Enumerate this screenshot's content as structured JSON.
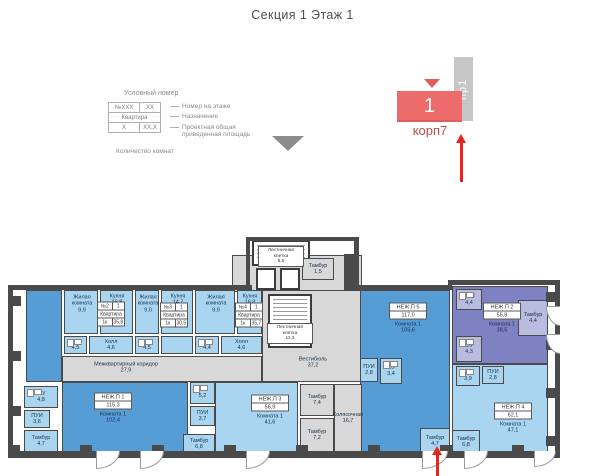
{
  "title": "Секция 1 Этаж 1",
  "legend": {
    "heading": "Условный номер",
    "rows": [
      [
        "№XXX",
        "XX"
      ],
      [
        "Квартира"
      ],
      [
        "X",
        "XX,X"
      ]
    ],
    "labels": [
      "Номер на этаже",
      "Назначение",
      "Проектная общая приведенная площадь"
    ],
    "footer": "Количество комнат"
  },
  "marker": {
    "tab": "пр1",
    "number": "1",
    "building": "корп7"
  },
  "colors": {
    "accent_red": "#e8251a",
    "marker_fill": "#ec6b6b",
    "marker_text": "#bf4e4a",
    "tab_fill": "#c6c6c6",
    "room_light": "#a9d5f0",
    "room_medium": "#569dd6",
    "room_purple": "#7e81c2",
    "room_common": "#d8d8d8",
    "wall": "#4a4a4a"
  },
  "plan": {
    "items": [
      {
        "t": "r",
        "id": "tower-base",
        "x": 232,
        "y": 255,
        "w": 130,
        "h": 37,
        "f": "gy"
      },
      {
        "t": "r",
        "id": "vestibule",
        "x": 262,
        "y": 290,
        "w": 100,
        "h": 92,
        "f": "gy",
        "label": [
          "Вестибюль",
          "37,2"
        ],
        "lx": 50,
        "ly": 72
      },
      {
        "t": "r",
        "id": "corridor",
        "x": 62,
        "y": 356,
        "w": 200,
        "h": 26,
        "f": "gy",
        "label": [
          "Межквартирный коридор",
          "27,9"
        ],
        "lx": 63,
        "ly": 11
      },
      {
        "t": "r",
        "id": "unit1-strip",
        "x": 26,
        "y": 290,
        "w": 36,
        "h": 92,
        "f": "mb"
      },
      {
        "t": "r",
        "id": "unit1-main",
        "x": 62,
        "y": 382,
        "w": 126,
        "h": 72,
        "f": "mb"
      },
      {
        "t": "r",
        "id": "unit5-main",
        "x": 360,
        "y": 290,
        "w": 90,
        "h": 164,
        "f": "mb"
      },
      {
        "t": "r",
        "id": "unit2-main",
        "x": 452,
        "y": 286,
        "w": 96,
        "h": 78,
        "f": "pu"
      },
      {
        "t": "r",
        "id": "unit4-main",
        "x": 452,
        "y": 364,
        "w": 96,
        "h": 90,
        "f": "lb"
      },
      {
        "t": "r",
        "id": "unit3-main",
        "x": 215,
        "y": 382,
        "w": 83,
        "h": 72,
        "f": "lb"
      },
      {
        "t": "r",
        "id": "living-room-1",
        "x": 64,
        "y": 290,
        "w": 34,
        "h": 44,
        "f": "lb",
        "label": [
          "Жилая",
          "комната",
          "9,9"
        ],
        "lx": 17,
        "ly": 13
      },
      {
        "t": "r",
        "id": "kitchen-1",
        "x": 100,
        "y": 290,
        "w": 33,
        "h": 44,
        "f": "lb",
        "label": [
          "Кухня",
          "16,8"
        ],
        "lx": 16,
        "ly": 9
      },
      {
        "t": "r",
        "id": "living-room-2",
        "x": 135,
        "y": 290,
        "w": 24,
        "h": 44,
        "f": "lb",
        "label": [
          "Жилая",
          "комната",
          "9,0"
        ],
        "lx": 12,
        "ly": 13
      },
      {
        "t": "r",
        "id": "kitchen-2",
        "x": 161,
        "y": 290,
        "w": 32,
        "h": 44,
        "f": "lb",
        "label": [
          "Кухня",
          "14,7"
        ],
        "lx": 16,
        "ly": 9
      },
      {
        "t": "r",
        "id": "living-room-3",
        "x": 195,
        "y": 290,
        "w": 40,
        "h": 44,
        "f": "lb",
        "label": [
          "Жилая",
          "комната",
          "9,9"
        ],
        "lx": 20,
        "ly": 13
      },
      {
        "t": "r",
        "id": "kitchen-3",
        "x": 237,
        "y": 290,
        "w": 25,
        "h": 44,
        "f": "lb",
        "label": [
          "Кухня",
          "16,8"
        ],
        "lx": 12,
        "ly": 9
      },
      {
        "t": "r",
        "id": "wc-apt2",
        "x": 64,
        "y": 336,
        "w": 23,
        "h": 18,
        "f": "lb",
        "fx": true,
        "label": [
          "С/У",
          "4,5"
        ]
      },
      {
        "t": "r",
        "id": "hall-apt2",
        "x": 89,
        "y": 336,
        "w": 44,
        "h": 18,
        "f": "lb",
        "label": [
          "Холл",
          "4,6"
        ]
      },
      {
        "t": "r",
        "id": "wc-apt3",
        "x": 135,
        "y": 336,
        "w": 24,
        "h": 18,
        "f": "lb",
        "fx": true,
        "label": [
          "С/У",
          "4,5"
        ]
      },
      {
        "t": "r",
        "id": "hall-apt3",
        "x": 161,
        "y": 336,
        "w": 32,
        "h": 18,
        "f": "lb"
      },
      {
        "t": "r",
        "id": "wc-apt4",
        "x": 195,
        "y": 336,
        "w": 24,
        "h": 18,
        "f": "lb",
        "fx": true,
        "label": [
          "С/У",
          "4,4"
        ]
      },
      {
        "t": "r",
        "id": "hall-apt4",
        "x": 221,
        "y": 336,
        "w": 41,
        "h": 18,
        "f": "lb",
        "label": [
          "Холл",
          "4,6"
        ]
      },
      {
        "t": "r",
        "id": "unit1-wc",
        "x": 24,
        "y": 386,
        "w": 34,
        "h": 22,
        "f": "lb",
        "fx": true,
        "label": [
          "С/У",
          "4,8"
        ]
      },
      {
        "t": "r",
        "id": "unit1-pui",
        "x": 24,
        "y": 410,
        "w": 26,
        "h": 18,
        "f": "lb",
        "label": [
          "ПУИ",
          "3,6"
        ]
      },
      {
        "t": "r",
        "id": "unit1-tambour",
        "x": 24,
        "y": 430,
        "w": 34,
        "h": 22,
        "f": "lb",
        "label": [
          "Тамбур",
          "4,7"
        ]
      },
      {
        "t": "r",
        "id": "unit3-wc",
        "x": 190,
        "y": 382,
        "w": 25,
        "h": 22,
        "f": "lb",
        "fx": true,
        "label": [
          "С/У",
          "5,2"
        ]
      },
      {
        "t": "r",
        "id": "unit3-pui",
        "x": 190,
        "y": 406,
        "w": 25,
        "h": 20,
        "f": "lb",
        "label": [
          "ПУИ",
          "3,7"
        ]
      },
      {
        "t": "r",
        "id": "unit3-tambour",
        "x": 183,
        "y": 434,
        "w": 32,
        "h": 20,
        "f": "lb",
        "label": [
          "Тамбур",
          "6,8"
        ]
      },
      {
        "t": "r",
        "id": "tambour-74",
        "x": 300,
        "y": 384,
        "w": 34,
        "h": 32,
        "f": "gy",
        "label": [
          "Тамбур",
          "7,4"
        ]
      },
      {
        "t": "r",
        "id": "tambour-72",
        "x": 300,
        "y": 418,
        "w": 34,
        "h": 34,
        "f": "gy",
        "label": [
          "Тамбур",
          "7,2"
        ]
      },
      {
        "t": "r",
        "id": "stroller-room",
        "x": 334,
        "y": 384,
        "w": 28,
        "h": 68,
        "f": "gy",
        "label": [
          "Колясочная",
          "16,7"
        ]
      },
      {
        "t": "r",
        "id": "unit5-pui",
        "x": 360,
        "y": 358,
        "w": 18,
        "h": 24,
        "f": "lb",
        "label": [
          "ПУИ",
          "2,8"
        ]
      },
      {
        "t": "r",
        "id": "unit5-wc",
        "x": 380,
        "y": 358,
        "w": 22,
        "h": 26,
        "f": "lb",
        "fx": true,
        "label": [
          "С/У",
          "3,4"
        ]
      },
      {
        "t": "r",
        "id": "unit5-tambour",
        "x": 420,
        "y": 428,
        "w": 30,
        "h": 26,
        "f": "lb",
        "label": [
          "Тамбур",
          "4,7"
        ]
      },
      {
        "t": "r",
        "id": "unit2-pui",
        "x": 456,
        "y": 289,
        "w": 26,
        "h": 21,
        "f": "lp",
        "fx": true,
        "label": [
          "ПУИ",
          "4,4"
        ]
      },
      {
        "t": "r",
        "id": "unit2-wc",
        "x": 456,
        "y": 336,
        "w": 26,
        "h": 26,
        "f": "lp",
        "fx": true,
        "label": [
          "С/У",
          "4,3"
        ]
      },
      {
        "t": "r",
        "id": "unit2-tambour",
        "x": 518,
        "y": 300,
        "w": 30,
        "h": 36,
        "f": "lp",
        "label": [
          "Тамбур",
          "4,4"
        ]
      },
      {
        "t": "r",
        "id": "unit4-wc",
        "x": 456,
        "y": 366,
        "w": 24,
        "h": 20,
        "f": "lb",
        "fx": true,
        "label": [
          "С/У",
          "3,9"
        ]
      },
      {
        "t": "r",
        "id": "unit4-pui",
        "x": 482,
        "y": 366,
        "w": 22,
        "h": 18,
        "f": "lb",
        "label": [
          "ПУИ",
          "2,8"
        ]
      },
      {
        "t": "r",
        "id": "unit4-tambour",
        "x": 452,
        "y": 430,
        "w": 28,
        "h": 24,
        "f": "lb",
        "label": [
          "Тамбур",
          "6,8"
        ]
      },
      {
        "t": "r",
        "id": "stair-upper",
        "x": 252,
        "y": 240,
        "w": 58,
        "h": 26,
        "f": "wh",
        "b2": true,
        "stairs": true,
        "blabel": [
          "Лестничная клетка",
          "5,5"
        ],
        "blat": "c"
      },
      {
        "t": "r",
        "id": "elevator-1",
        "x": 256,
        "y": 268,
        "w": 20,
        "h": 22,
        "f": "wh",
        "b2": true
      },
      {
        "t": "r",
        "id": "elevator-2",
        "x": 280,
        "y": 268,
        "w": 20,
        "h": 22,
        "f": "wh",
        "b2": true
      },
      {
        "t": "r",
        "id": "tambour-top",
        "x": 302,
        "y": 258,
        "w": 32,
        "h": 22,
        "f": "gy",
        "label": [
          "Тамбур",
          "1,5"
        ]
      },
      {
        "t": "r",
        "id": "stair-main",
        "x": 268,
        "y": 294,
        "w": 44,
        "h": 54,
        "f": "wh",
        "b2": true,
        "stairs": true,
        "blabel": [
          "Лестничная клетка",
          "11,3"
        ]
      },
      {
        "t": "t",
        "id": "unit5-tag",
        "x": 408,
        "y": 318,
        "box": [
          "НЕЖ.П 5",
          "117,0"
        ],
        "sub": [
          "Комната 1",
          "105,6"
        ]
      },
      {
        "t": "t",
        "id": "unit1-tag",
        "x": 113,
        "y": 408,
        "box": [
          "НЕЖ.П 1",
          "115,3"
        ],
        "sub": [
          "Комната 1",
          "102,4"
        ]
      },
      {
        "t": "t",
        "id": "unit3-tag",
        "x": 270,
        "y": 410,
        "box": [
          "НЕЖ.П 3",
          "56,9"
        ],
        "sub": [
          "Комната 1",
          "41,6"
        ]
      },
      {
        "t": "t",
        "id": "unit2-tag",
        "x": 502,
        "y": 318,
        "box": [
          "НЕЖ.П 2",
          "55,8"
        ],
        "sub": [
          "Комната 1",
          "38,5"
        ]
      },
      {
        "t": "t",
        "id": "unit4-tag",
        "x": 513,
        "y": 418,
        "box": [
          "НЕЖ.П 4",
          "62,1"
        ],
        "sub": [
          "Комната 1",
          "47,1"
        ]
      },
      {
        "t": "a",
        "id": "apt2-tag",
        "x": 111,
        "y": 314,
        "rows": [
          [
            "№2",
            "1"
          ],
          [
            "Квартира"
          ],
          [
            "1к",
            "35,8"
          ]
        ]
      },
      {
        "t": "a",
        "id": "apt3-tag",
        "x": 174,
        "y": 315,
        "rows": [
          [
            "№3",
            "1"
          ],
          [
            "Квартира"
          ],
          [
            "1к",
            "30,5"
          ]
        ]
      },
      {
        "t": "a",
        "id": "apt4-tag",
        "x": 249,
        "y": 315,
        "rows": [
          [
            "№4",
            "1"
          ],
          [
            "Квартира"
          ],
          [
            "1к",
            "35,7"
          ]
        ]
      },
      {
        "t": "d",
        "x": 96,
        "y": 451,
        "w": 24,
        "h": 18
      },
      {
        "t": "d",
        "x": 140,
        "y": 451,
        "w": 24,
        "h": 18
      },
      {
        "t": "d",
        "x": 246,
        "y": 451,
        "w": 24,
        "h": 18
      },
      {
        "t": "d",
        "x": 422,
        "y": 451,
        "w": 26,
        "h": 18
      },
      {
        "t": "d",
        "x": 464,
        "y": 451,
        "w": 24,
        "h": 18
      },
      {
        "t": "d",
        "x": 534,
        "y": 451,
        "w": 22,
        "h": 16
      },
      {
        "t": "d",
        "r": true,
        "x": 546,
        "y": 306,
        "w": 14,
        "h": 20
      },
      {
        "t": "d",
        "r": true,
        "x": 546,
        "y": 334,
        "w": 14,
        "h": 20
      }
    ]
  }
}
